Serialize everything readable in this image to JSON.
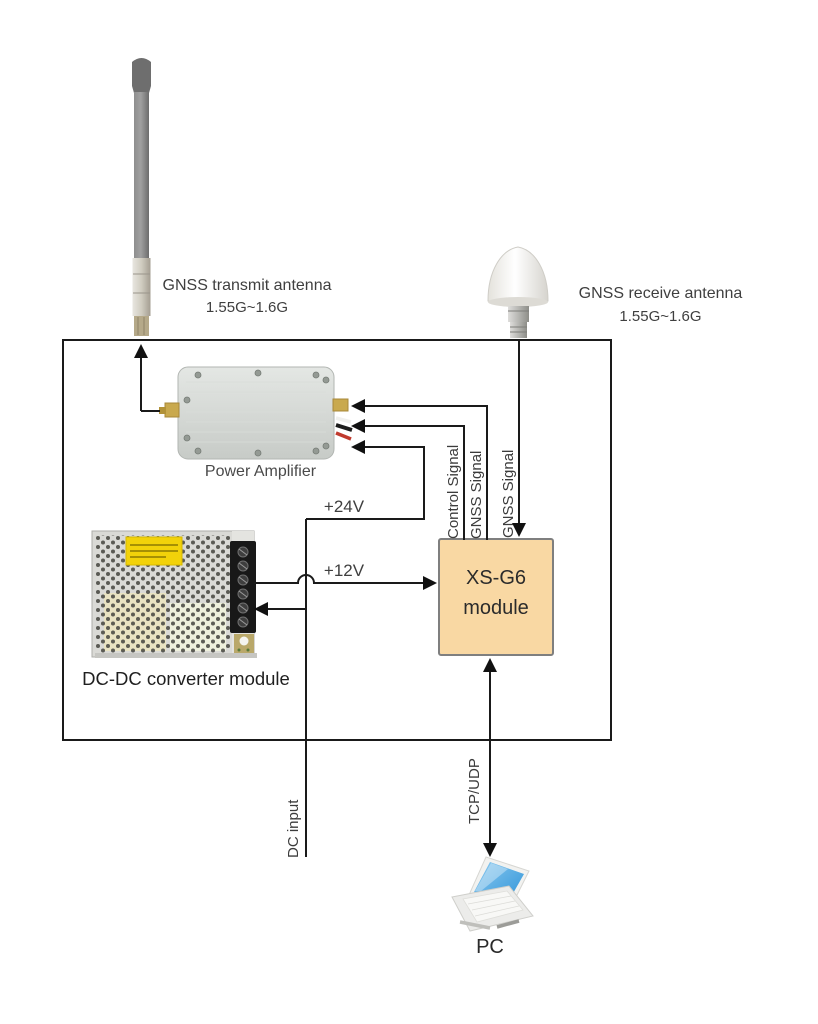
{
  "diagram": {
    "transmit_antenna": {
      "name": "GNSS transmit antenna",
      "freq_range": "1.55G~1.6G"
    },
    "receive_antenna": {
      "name": "GNSS receive antenna",
      "freq_range": "1.55G~1.6G"
    },
    "power_amplifier": {
      "label": "Power Amplifier"
    },
    "dcdc_converter": {
      "label": "DC-DC converter module"
    },
    "xsg6_module": {
      "line1": "XS-G6",
      "line2": "module"
    },
    "pc": {
      "label": "PC"
    },
    "signals": {
      "control_signal": "Control Signal",
      "gnss_signal_tx": "GNSS Signal",
      "gnss_signal_rx": "GNSS Signal",
      "supply_24v": "+24V",
      "supply_12v": "+12V",
      "dc_input": "DC input",
      "tcp_udp": "TCP/UDP"
    },
    "colors": {
      "module_fill": "#f9d8a3",
      "module_border": "#7f7f7f",
      "warning_yellow": "#f2d20a",
      "screen_blue": "#3fa0de",
      "line_black": "#1a1a1a"
    }
  }
}
